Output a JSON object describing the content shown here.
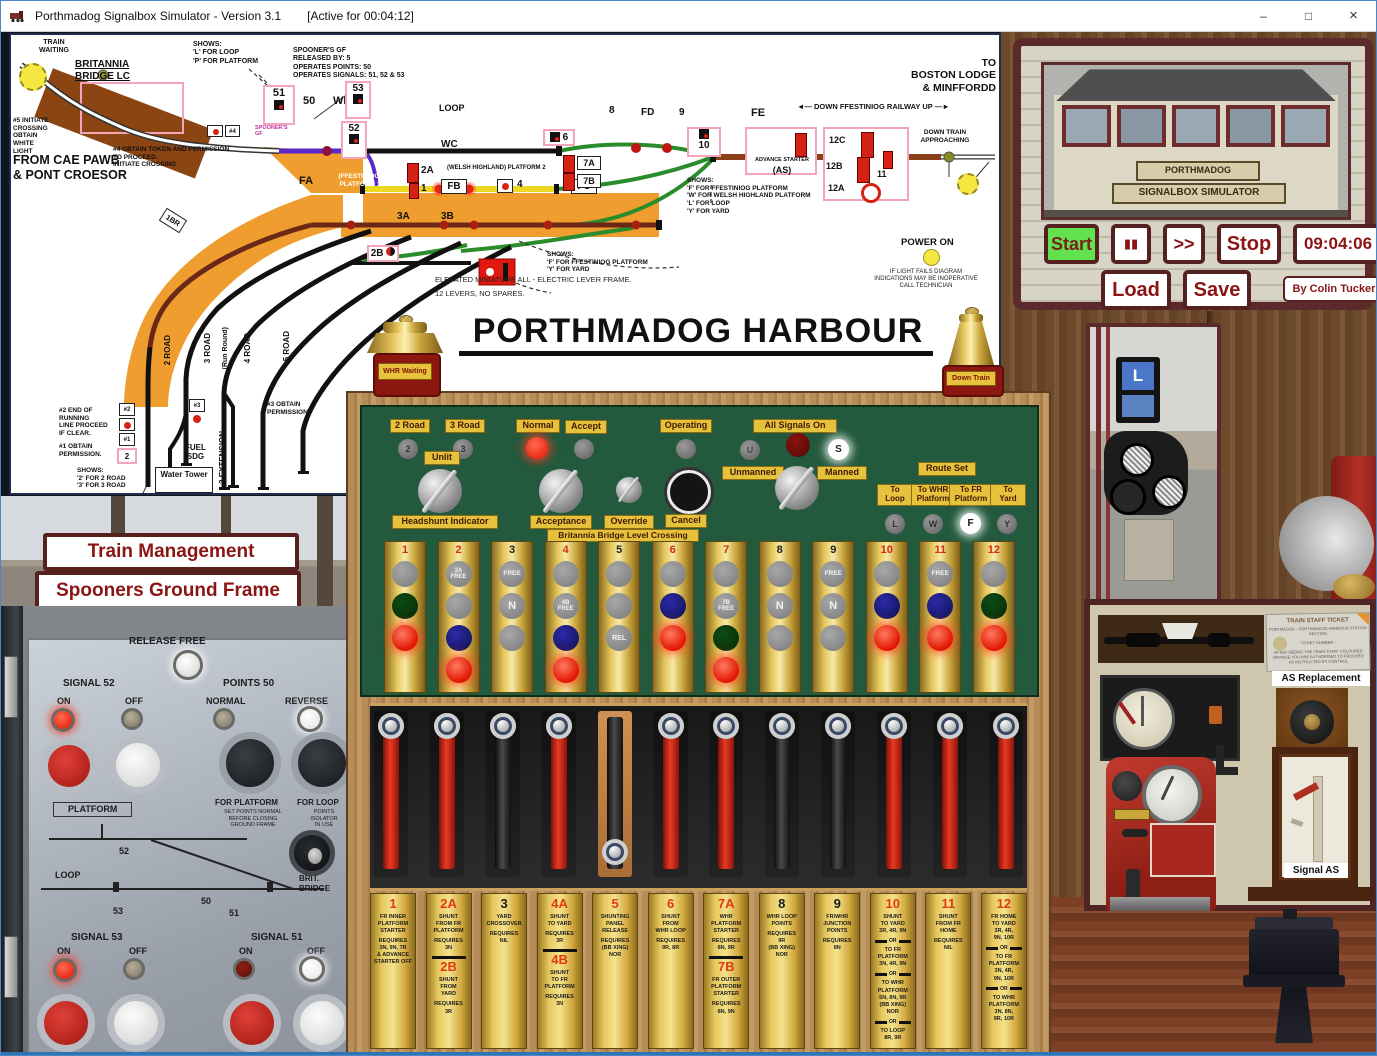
{
  "window": {
    "title": "Porthmadog Signalbox Simulator - Version 3.1",
    "active": "[Active for 00:04:12]",
    "minimize": "–",
    "maximize": "□",
    "close": "×"
  },
  "diagram": {
    "labels": {
      "tw": "TRAIN\nWAITING",
      "brit": "BRITANNIA\nBRIDGE LC",
      "init5": "#5 INITIATE\nCROSSING\nOBTAIN\nWHITE\nLIGHT",
      "cae": "FROM CAE PAWB\n& PONT CROESOR",
      "shows_lp": "SHOWS:\n'L' FOR LOOP\n'P' FOR PLATFORM",
      "sp_note": "SPOONER'S GF\nRELEASED BY: 5\nOPERATES POINTS: 50\nOPERATES SIGNALS: 51, 52 & 53",
      "sp_small": "SPOONER'S\nGF",
      "ob4": "#4 OBTAIN TOKEN AND PERMISSION\nTO PROCEED.\nINITIATE CROSSING",
      "h4": "#4",
      "h2": "#2",
      "h1": "#1",
      "h3": "#3",
      "pp2": "2",
      "n51": "51",
      "n50": "50",
      "wb": "WB",
      "n53": "53",
      "n52": "52",
      "loop": "LOOP",
      "wc": "WC",
      "n8": "8",
      "fd": "FD",
      "n9": "9",
      "fe": "FE",
      "du": "◄— DOWN    FFESTINIOG RAILWAY    UP —►",
      "boston": "TO\nBOSTON LODGE\n& MINFFORDD",
      "n10": "10",
      "adv": "ADVANCE STARTER",
      "as": "(AS)",
      "c12": "12C",
      "b12": "12B",
      "a12": "12A",
      "n11x": "11",
      "dta": "DOWN TRAIN\nAPPROACHING",
      "fwly": "SHOWS:\n'F' FOR FFESTINIOG PLATFORM\n'W' FOR WELSH HIGHLAND PLATFORM\n'L' FOR LOOP\n'Y' FOR YARD",
      "p1": "(FFESTINIOG)\nPLATFORM 1",
      "p2": "(WELSH HIGHLAND) PLATFORM 2",
      "fa": "FA",
      "fb": "FB",
      "fc": "FC",
      "a2": "2A",
      "o1": "1",
      "n4x": "4",
      "n6x": "6",
      "a7": "7A",
      "b7": "7B",
      "a3": "3A",
      "b3": "3B",
      "b2": "2B",
      "br1": "1BR",
      "fy": "SHOWS:\n'F' FOR FFESTINIOG PLATFORM\n'Y' FOR YARD",
      "elev": "ELEVATED MINIATURE ALL - ELECTRIC LEVER FRAME.\n12 LEVERS, NO SPARES.",
      "r2": "2 ROAD",
      "r3": "3 ROAD",
      "rr": "(Run Round)",
      "r4": "4 ROAD",
      "r5": "5 ROAD",
      "e3": "3 EXTENSION",
      "end2": "#2 END OF\nRUNNING\nLINE PROCEED\nIF CLEAR.",
      "ob1": "#1 OBTAIN\nPERMISSION.",
      "s23": "SHOWS:\n'2' FOR 2 ROAD\n'3' FOR 3 ROAD",
      "ob3": "#3 OBTAIN\nPERMISSION.",
      "fuel": "FUEL\nSDG",
      "water": "Water\nTower",
      "pwr": "POWER ON",
      "fail": "IF LIGHT FAILS DIAGRAM\nINDICATIONS MAY BE INOPERATIVE\nCALL TECHNICIAN",
      "title": "PORTHMADOG HARBOUR"
    },
    "bells": {
      "left": "WHR Waiting",
      "right": "Down Train"
    }
  },
  "sim_panel": {
    "sign1": "PORTHMADOG",
    "sign2": "SIGNALBOX SIMULATOR",
    "start": "Start",
    "pause": "▮▮",
    "ffwd": ">>",
    "stop": "Stop",
    "clock": "09:04:06",
    "load": "Load",
    "save": "Save",
    "credit": "By Colin Tucker"
  },
  "management": {
    "train_management": "Train Management",
    "spooners": "Spooners Ground Frame"
  },
  "frame": {
    "controls": {
      "two_road": "2 Road",
      "three_road": "3 Road",
      "l2": "2",
      "l3": "3",
      "unlit": "Unlit",
      "headshunt": "Headshunt Indicator",
      "normal": "Normal",
      "accept": "Accept",
      "acceptance": "Acceptance",
      "override": "Override",
      "operating": "Operating",
      "cancel": "Cancel",
      "bblc": "Britannia Bridge Level Crossing",
      "all_signals": "All Signals On",
      "unmanned": "Unmanned",
      "manned": "Manned",
      "lu": "U",
      "ls": "S",
      "route_set": "Route Set",
      "to_loop": "To\nLoop",
      "to_whr": "To WHR\nPlatform",
      "to_fr": "To FR\nPlatform",
      "to_yard": "To\nYard",
      "ll": "L",
      "lw": "W",
      "lf": "F",
      "ly": "Y"
    },
    "indicators": [
      {
        "num": "1",
        "color": "red",
        "lamps": [
          {
            "c": "gray"
          },
          {
            "c": "dgreen"
          },
          {
            "c": "redlit"
          }
        ]
      },
      {
        "num": "2",
        "color": "red",
        "lamps": [
          {
            "c": "gray",
            "t": "2A\nFREE",
            "fs": 6
          },
          {
            "c": "gray"
          },
          {
            "c": "blue"
          },
          {
            "c": "redlit"
          }
        ]
      },
      {
        "num": "3",
        "color": "black",
        "lamps": [
          {
            "c": "gray",
            "t": "FREE",
            "fs": 6.5
          },
          {
            "c": "gray",
            "t": "N",
            "fs": 11
          },
          {
            "c": "gray"
          }
        ]
      },
      {
        "num": "4",
        "color": "red",
        "lamps": [
          {
            "c": "gray"
          },
          {
            "c": "gray",
            "t": "4B\nFREE",
            "fs": 6
          },
          {
            "c": "blue"
          },
          {
            "c": "redlit"
          }
        ]
      },
      {
        "num": "5",
        "color": "black",
        "lamps": [
          {
            "c": "gray"
          },
          {
            "c": "gray"
          },
          {
            "c": "gray",
            "t": "REL",
            "fs": 7
          }
        ]
      },
      {
        "num": "6",
        "color": "red",
        "lamps": [
          {
            "c": "gray"
          },
          {
            "c": "blue"
          },
          {
            "c": "redlit"
          }
        ]
      },
      {
        "num": "7",
        "color": "red",
        "lamps": [
          {
            "c": "gray"
          },
          {
            "c": "gray",
            "t": "7B\nFREE",
            "fs": 6
          },
          {
            "c": "dgreen"
          },
          {
            "c": "redlit"
          }
        ]
      },
      {
        "num": "8",
        "color": "black",
        "lamps": [
          {
            "c": "gray"
          },
          {
            "c": "gray",
            "t": "N",
            "fs": 11
          },
          {
            "c": "gray"
          }
        ]
      },
      {
        "num": "9",
        "color": "black",
        "lamps": [
          {
            "c": "gray",
            "t": "FREE",
            "fs": 6.5
          },
          {
            "c": "gray",
            "t": "N",
            "fs": 11
          },
          {
            "c": "gray"
          }
        ]
      },
      {
        "num": "10",
        "color": "red",
        "lamps": [
          {
            "c": "gray"
          },
          {
            "c": "blue"
          },
          {
            "c": "redlit"
          }
        ]
      },
      {
        "num": "11",
        "color": "red",
        "lamps": [
          {
            "c": "gray",
            "t": "FREE",
            "fs": 6.5
          },
          {
            "c": "blue"
          },
          {
            "c": "redlit"
          }
        ]
      },
      {
        "num": "12",
        "color": "red",
        "lamps": [
          {
            "c": "gray"
          },
          {
            "c": "dgreen"
          },
          {
            "c": "redlit"
          }
        ]
      }
    ],
    "levers": [
      {
        "c": "red"
      },
      {
        "c": "red"
      },
      {
        "c": "black"
      },
      {
        "c": "red"
      },
      {
        "c": "black",
        "pulled": true
      },
      {
        "c": "red"
      },
      {
        "c": "red"
      },
      {
        "c": "black"
      },
      {
        "c": "black"
      },
      {
        "c": "red"
      },
      {
        "c": "red"
      },
      {
        "c": "red"
      }
    ],
    "plates": [
      {
        "parts": [
          {
            "t": "num",
            "v": "1",
            "c": "red"
          },
          {
            "t": "txt",
            "v": "FR INNER\nPLATFORM\nSTARTER"
          },
          {
            "t": "txt",
            "v": "REQUIRES\n3N, 9N, 7R\n& ADVANCE\nSTARTER OFF"
          }
        ]
      },
      {
        "parts": [
          {
            "t": "num",
            "v": "2A",
            "c": "red"
          },
          {
            "t": "txt",
            "v": "SHUNT\nFROM FR\nPLATFORM"
          },
          {
            "t": "txt",
            "v": "REQUIRES\n3N"
          },
          {
            "t": "rule"
          },
          {
            "t": "num",
            "v": "2B",
            "c": "red"
          },
          {
            "t": "txt",
            "v": "SHUNT\nFROM\nYARD"
          },
          {
            "t": "txt",
            "v": "REQUIRES\n3R"
          }
        ]
      },
      {
        "parts": [
          {
            "t": "num",
            "v": "3",
            "c": "black"
          },
          {
            "t": "txt",
            "v": "YARD\nCROSSOVER"
          },
          {
            "t": "txt",
            "v": "REQUIRES\nNIL"
          }
        ]
      },
      {
        "parts": [
          {
            "t": "num",
            "v": "4A",
            "c": "red"
          },
          {
            "t": "txt",
            "v": "SHUNT\nTO YARD"
          },
          {
            "t": "txt",
            "v": "REQUIRES\n3R"
          },
          {
            "t": "rule"
          },
          {
            "t": "num",
            "v": "4B",
            "c": "red"
          },
          {
            "t": "txt",
            "v": "SHUNT\nTO FR\nPLATFORM"
          },
          {
            "t": "txt",
            "v": "REQUIRES\n3N"
          }
        ]
      },
      {
        "parts": [
          {
            "t": "num",
            "v": "5",
            "c": "red"
          },
          {
            "t": "txt",
            "v": "SHUNTING\nPANEL\nRELEASE"
          },
          {
            "t": "txt",
            "v": "REQUIRES\n(BB XING) NOR"
          }
        ]
      },
      {
        "parts": [
          {
            "t": "num",
            "v": "6",
            "c": "red"
          },
          {
            "t": "txt",
            "v": "SHUNT\nFROM\nWHR LOOP"
          },
          {
            "t": "txt",
            "v": "REQUIRES\n9R, 8R"
          }
        ]
      },
      {
        "parts": [
          {
            "t": "num",
            "v": "7A",
            "c": "red"
          },
          {
            "t": "txt",
            "v": "WHR\nPLATFORM\nSTARTER"
          },
          {
            "t": "txt",
            "v": "REQUIRES\n8N, 9R"
          },
          {
            "t": "rule"
          },
          {
            "t": "num",
            "v": "7B",
            "c": "red"
          },
          {
            "t": "txt",
            "v": "FR OUTER\nPLATFORM\nSTARTER"
          },
          {
            "t": "txt",
            "v": "REQUIRES\n8N, 9N"
          }
        ]
      },
      {
        "parts": [
          {
            "t": "num",
            "v": "8",
            "c": "black"
          },
          {
            "t": "txt",
            "v": "WHR LOOP\nPOINTS"
          },
          {
            "t": "txt",
            "v": "REQUIRES\n9R\n(BB XING) NOR"
          }
        ]
      },
      {
        "parts": [
          {
            "t": "num",
            "v": "9",
            "c": "black"
          },
          {
            "t": "txt",
            "v": "FR/WHR\nJUNCTION\nPOINTS"
          },
          {
            "t": "txt",
            "v": "REQUIRES\n8N"
          }
        ]
      },
      {
        "parts": [
          {
            "t": "num",
            "v": "10",
            "c": "red"
          },
          {
            "t": "txt",
            "v": "SHUNT\nTO YARD\n3R, 4R, 9N"
          },
          {
            "t": "or",
            "v": "OR"
          },
          {
            "t": "txt",
            "v": "TO FR\nPLATFORM\n3N, 4R, 9N"
          },
          {
            "t": "or",
            "v": "OR"
          },
          {
            "t": "txt",
            "v": "TO WHR\nPLATFORM\n5N, 8N, 9R\n(BB XING) NOR"
          },
          {
            "t": "or",
            "v": "OR"
          },
          {
            "t": "txt",
            "v": "TO LOOP\n8R, 9R"
          }
        ]
      },
      {
        "parts": [
          {
            "t": "num",
            "v": "11",
            "c": "red"
          },
          {
            "t": "txt",
            "v": "SHUNT\nFROM FR\nHOME"
          },
          {
            "t": "txt",
            "v": "REQUIRES\nNIL"
          }
        ]
      },
      {
        "parts": [
          {
            "t": "num",
            "v": "12",
            "c": "red"
          },
          {
            "t": "txt",
            "v": "FR HOME\nTO YARD\n3R, 4R,\n9N, 10R"
          },
          {
            "t": "or",
            "v": "OR"
          },
          {
            "t": "txt",
            "v": "TO FR\nPLATFORM\n3N, 4R,\n9N, 10R"
          },
          {
            "t": "or",
            "v": "OR"
          },
          {
            "t": "txt",
            "v": "TO WHR\nPLATFORM\n3N, 8N,\n9R, 10R"
          }
        ]
      }
    ]
  },
  "ground_frame": {
    "release_free": "RELEASE FREE",
    "signal52": "SIGNAL 52",
    "signal53": "SIGNAL 53",
    "signal51": "SIGNAL 51",
    "points50": "POINTS 50",
    "on": "ON",
    "off": "OFF",
    "normal": "NORMAL",
    "reverse": "REVERSE",
    "for_platform": "FOR PLATFORM",
    "platform_note": "SET POINTS NORMAL\nBEFORE CLOSING\nGROUND FRAME",
    "for_loop": "FOR LOOP",
    "loop_note": "POINTS\nISOLATOR\nIN USE",
    "platform": "PLATFORM",
    "loop": "LOOP",
    "n50": "50",
    "n51": "51",
    "n52": "52",
    "n53": "53",
    "brit_bridge": "BRIT.\nBRIDGE"
  },
  "signal_photo": {
    "indicator": "L"
  },
  "museum": {
    "ticket_title": "TRAIN STAFF TICKET",
    "ticket_line1": "PORTMADOG - PORTHMADOG HARBOUR STATION SECTION",
    "ticket_number": "TICKET NUMBER :",
    "ticket_note": "AFTER SEEING THE TRAIN STAFF COLOURED ORANGE YOU ARE AUTHORISED TO PROCEED AS INSTRUCTED BY CONTROL",
    "as_replacement": "AS  Replacement",
    "signal_as": "Signal  AS"
  }
}
